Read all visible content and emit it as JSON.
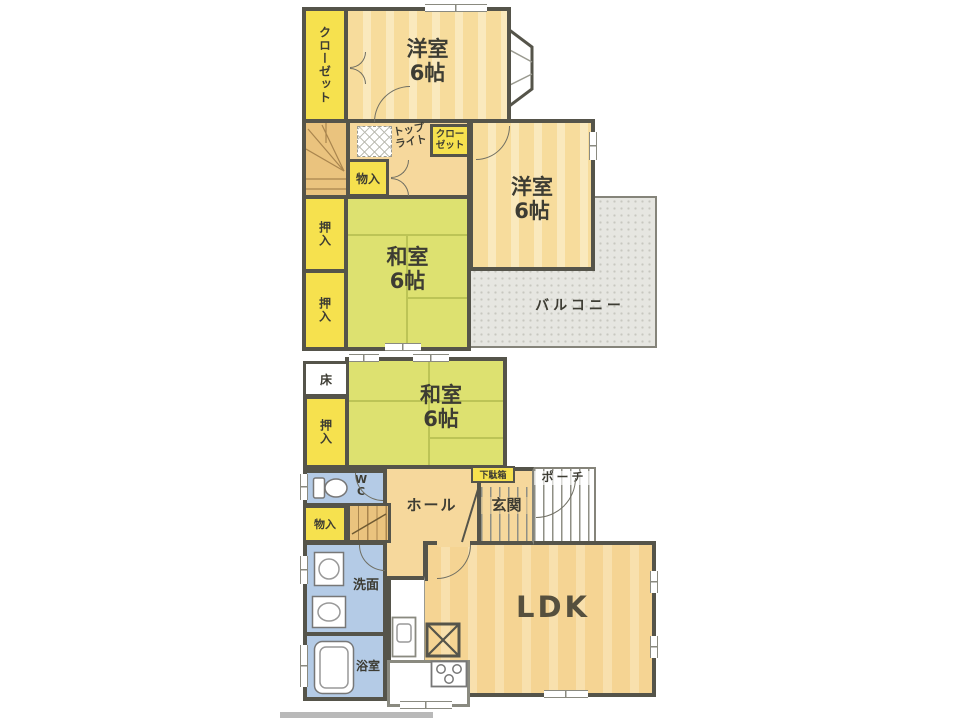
{
  "colors": {
    "wall": "#55544a",
    "thin": "#85847a",
    "peach": "#f7dc9c",
    "tatami": "#dde170",
    "yellow": "#f6e14e",
    "blue": "#b4cbe6",
    "hallFloor": "#f6d89c",
    "ldkFloor": "#f5d493",
    "stairs": "#eac37e",
    "balcony": "#e6e6e1",
    "ink": "#3d3c33"
  },
  "floor2": {
    "closet_left": "クローゼット",
    "yoshitsu_top": "洋室\n6帖",
    "toplight": "トップ\nライト",
    "closet_small": "クロー\nゼット",
    "monoiri": "物入",
    "oshiire_a": "押入",
    "oshiire_b": "押入",
    "washitsu": "和室\n6帖",
    "yoshitsu_right": "洋室\n6帖",
    "balcony": "バルコニー"
  },
  "floor1": {
    "toko": "床",
    "oshiire": "押入",
    "washitsu": "和室\n6帖",
    "wc": "W\nC",
    "monoiri": "物入",
    "getabako": "下駄箱",
    "hall": "ホール",
    "genkan": "玄関",
    "porch": "ポーチ",
    "senmen": "洗面",
    "bath": "浴室",
    "ldk": "LDK"
  }
}
